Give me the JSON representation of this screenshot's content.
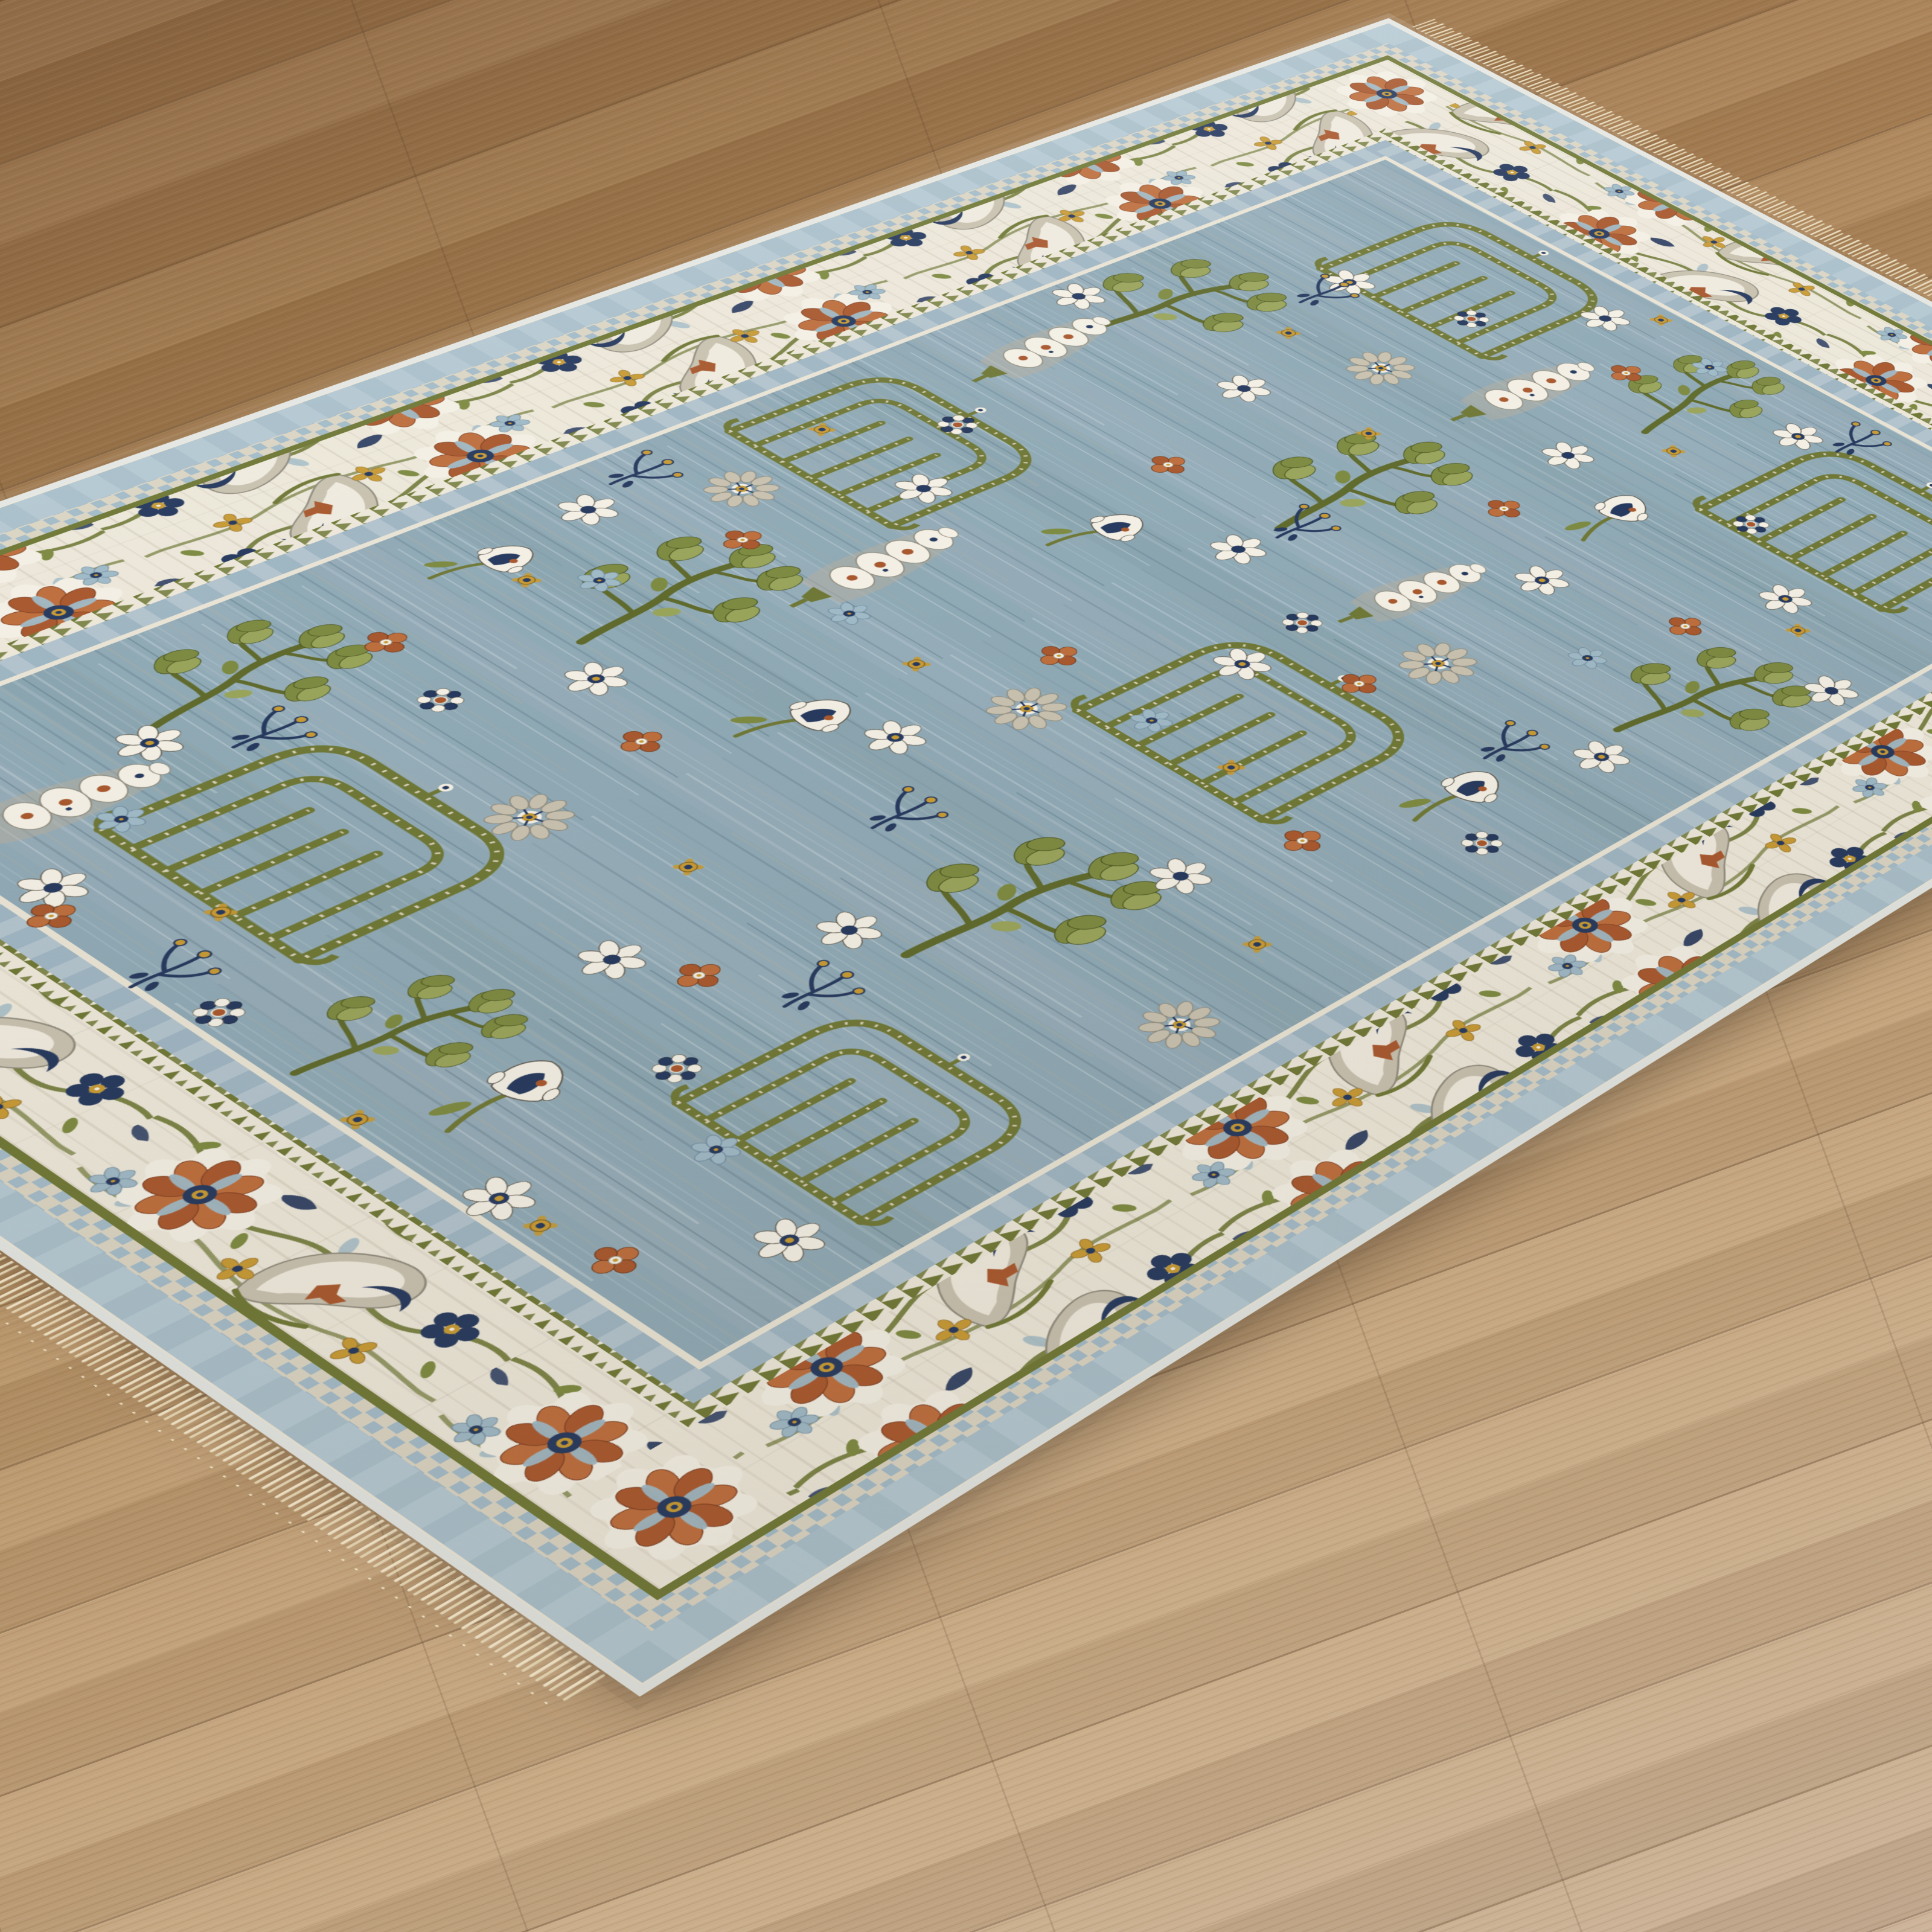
{
  "scene": {
    "description": "Angled corner view of a traditional Oushak-style area rug with a slate blue field and ivory floral border, lying on light oak wood plank flooring; cream fringe on the near and far ends",
    "floor": {
      "material": "oak-plank-floor",
      "plank_angle_deg": -20,
      "colors": {
        "c1": "#8a6440",
        "c2": "#9a744a",
        "c3": "#a98156",
        "c4": "#b49064",
        "c5": "#bf9e76",
        "c6": "#c7aa86",
        "c7": "#c9b096",
        "seam": "rgba(70,44,24,0.30)",
        "crossseam": "rgba(72,47,26,0.16)"
      }
    },
    "rug": {
      "style": "traditional-floral-oushak",
      "palette": {
        "field": "#8fa9b5",
        "ivory": "#ece7d9",
        "white": "#f3efe4",
        "gray_beige": "#c8c1af",
        "gray_stroke": "#8f8b7d",
        "olive": "#6f7836",
        "leaf": "#7d8a41",
        "leaf_light": "#99a45b",
        "leaf_dark": "#46511f",
        "trunk": "#5f6a2c",
        "rust": "#a8582e",
        "rust_light": "#bd6e3d",
        "navy": "#26395e",
        "gold": "#c79a35",
        "lightblue": "#9fb9c6",
        "checker_blue": "#a3bbc8",
        "checker_beige": "#dad4c3",
        "bluegray": "#9eb5c2",
        "blueband": "#a9bfca",
        "silver": "#e3e6e2",
        "hairline": "#e8e3d4",
        "fringe": "#e9dcc0",
        "fringe_dark": "#ddcdab",
        "dot": "#d8d1bd"
      },
      "border": {
        "motif_cycle": [
          "rust-rosette",
          "gray-palmette",
          "navy-trefoil",
          "gold-floret",
          "olive-vine"
        ],
        "rings": [
          {
            "name": "silver-binding",
            "inset": 5,
            "width": 10,
            "color": "silver"
          },
          {
            "name": "blue-outer-band",
            "inset": 35,
            "width": 46,
            "color": "blueband",
            "dash": {
              "color": "#bdd0d9",
              "array": "34 30",
              "opacity": 0.55
            }
          },
          {
            "name": "checker-guard",
            "inset": 72,
            "width": 28,
            "pattern": "pat-check"
          },
          {
            "name": "olive-line",
            "inset": 91,
            "width": 10,
            "color": "olive"
          },
          {
            "name": "sawtooth-guard",
            "inset": 262,
            "width": 24,
            "pattern": "pat-saw"
          },
          {
            "name": "bluegray-band",
            "inset": 291,
            "width": 34,
            "color": "bluegray",
            "dash": {
              "color": "#c6d2d8",
              "array": "22 26",
              "opacity": 0.5
            }
          },
          {
            "name": "ivory-hairline",
            "inset": 312,
            "width": 8,
            "color": "hairline"
          }
        ],
        "ivory_ring": {
          "outer": 96,
          "inner": 250
        },
        "field_inset": 316
      },
      "field_motifs": [
        {
          "t": "trellis",
          "x": 0.32,
          "y": 0.17
        },
        {
          "t": "trellis",
          "x": 0.7,
          "y": 0.19,
          "s": 1.05
        },
        {
          "t": "trellis",
          "x": 0.25,
          "y": 0.465,
          "s": 0.95
        },
        {
          "t": "trellis",
          "x": 0.615,
          "y": 0.5
        },
        {
          "t": "trellis",
          "x": 0.38,
          "y": 0.8,
          "s": 1.05
        },
        {
          "t": "trellis",
          "x": 0.745,
          "y": 0.77,
          "s": 0.9
        },
        {
          "t": "branch",
          "x": 0.52,
          "y": 0.16,
          "s": 0.9,
          "r": -8
        },
        {
          "t": "branch",
          "x": 0.22,
          "y": 0.285,
          "r": 6
        },
        {
          "t": "branch",
          "x": 0.46,
          "y": 0.335,
          "s": 1.05,
          "r": -4
        },
        {
          "t": "branch",
          "x": 0.77,
          "y": 0.345,
          "s": 0.95,
          "r": 10
        },
        {
          "t": "branch",
          "x": 0.3,
          "y": 0.6,
          "r": -6
        },
        {
          "t": "branch",
          "x": 0.66,
          "y": 0.645,
          "s": 1.05,
          "r": 5
        },
        {
          "t": "branch",
          "x": 0.225,
          "y": 0.75,
          "s": 0.9,
          "r": -10
        },
        {
          "t": "branch",
          "x": 0.54,
          "y": 0.845,
          "s": 0.8,
          "r": 8
        },
        {
          "t": "pod",
          "x": 0.445,
          "y": 0.215,
          "r": 3
        },
        {
          "t": "pod",
          "x": 0.215,
          "y": 0.355,
          "s": 0.95,
          "r": -5
        },
        {
          "t": "pod",
          "x": 0.575,
          "y": 0.375,
          "s": 0.9,
          "r": 6
        },
        {
          "t": "pod",
          "x": 0.35,
          "y": 0.525,
          "r": -3
        },
        {
          "t": "pod",
          "x": 0.27,
          "y": 0.84,
          "s": 0.95,
          "r": 4
        },
        {
          "t": "tulip",
          "x": 0.59,
          "y": 0.27,
          "r": -15
        },
        {
          "t": "tulip",
          "x": 0.4,
          "y": 0.445,
          "s": 0.95,
          "r": 10
        },
        {
          "t": "tulip",
          "x": 0.745,
          "y": 0.475,
          "r": -5
        },
        {
          "t": "tulip",
          "x": 0.445,
          "y": 0.625,
          "r": 12
        },
        {
          "t": "tulip",
          "x": 0.615,
          "y": 0.845,
          "s": 1.05,
          "r": -10
        },
        {
          "t": "tulip",
          "x": 0.21,
          "y": 0.64,
          "s": 0.9,
          "r": 8
        },
        {
          "t": "rosette",
          "x": 0.365,
          "y": 0.255
        },
        {
          "t": "rosette",
          "x": 0.64,
          "y": 0.41,
          "s": 1.05
        },
        {
          "t": "rosette",
          "x": 0.235,
          "y": 0.53,
          "s": 0.95
        },
        {
          "t": "rosette",
          "x": 0.52,
          "y": 0.555
        },
        {
          "t": "rosette",
          "x": 0.43,
          "y": 0.735
        },
        {
          "t": "rosette",
          "x": 0.8,
          "y": 0.655,
          "s": 0.95
        },
        {
          "t": "daisy",
          "x": 0.41,
          "y": 0.14
        },
        {
          "t": "daisy",
          "x": 0.8,
          "y": 0.125
        },
        {
          "t": "daisy",
          "x": 0.52,
          "y": 0.245
        },
        {
          "t": "daisy",
          "x": 0.33,
          "y": 0.315
        },
        {
          "t": "daisy",
          "x": 0.82,
          "y": 0.3
        },
        {
          "t": "daisy",
          "x": 0.47,
          "y": 0.41
        },
        {
          "t": "daisy",
          "x": 0.3,
          "y": 0.475
        },
        {
          "t": "daisy",
          "x": 0.2,
          "y": 0.585
        },
        {
          "t": "daisy",
          "x": 0.7,
          "y": 0.59
        },
        {
          "t": "daisy",
          "x": 0.62,
          "y": 0.7
        },
        {
          "t": "daisy",
          "x": 0.56,
          "y": 0.77
        },
        {
          "t": "daisy",
          "x": 0.33,
          "y": 0.875
        },
        {
          "t": "daisy",
          "x": 0.178,
          "y": 0.315
        },
        {
          "t": "daisyg",
          "x": 0.6,
          "y": 0.15
        },
        {
          "t": "daisyg",
          "x": 0.27,
          "y": 0.21
        },
        {
          "t": "daisyg",
          "x": 0.73,
          "y": 0.26
        },
        {
          "t": "daisyg",
          "x": 0.615,
          "y": 0.33
        },
        {
          "t": "daisyg",
          "x": 0.775,
          "y": 0.41
        },
        {
          "t": "daisyg",
          "x": 0.565,
          "y": 0.47
        },
        {
          "t": "daisyg",
          "x": 0.495,
          "y": 0.605
        },
        {
          "t": "daisyg",
          "x": 0.345,
          "y": 0.66
        },
        {
          "t": "daisyg",
          "x": 0.25,
          "y": 0.8
        },
        {
          "t": "daisyg",
          "x": 0.8,
          "y": 0.83
        },
        {
          "t": "daisyg",
          "x": 0.68,
          "y": 0.88
        },
        {
          "t": "clover",
          "x": 0.47,
          "y": 0.17
        },
        {
          "t": "clover",
          "x": 0.54,
          "y": 0.3
        },
        {
          "t": "clover",
          "x": 0.71,
          "y": 0.31
        },
        {
          "t": "clover",
          "x": 0.37,
          "y": 0.385
        },
        {
          "t": "clover",
          "x": 0.625,
          "y": 0.445
        },
        {
          "t": "clover",
          "x": 0.28,
          "y": 0.555
        },
        {
          "t": "clover",
          "x": 0.49,
          "y": 0.52
        },
        {
          "t": "clover",
          "x": 0.72,
          "y": 0.54
        },
        {
          "t": "clover",
          "x": 0.41,
          "y": 0.675
        },
        {
          "t": "clover",
          "x": 0.245,
          "y": 0.7
        },
        {
          "t": "clover",
          "x": 0.6,
          "y": 0.755
        },
        {
          "t": "clover",
          "x": 0.35,
          "y": 0.885
        },
        {
          "t": "clover",
          "x": 0.755,
          "y": 0.875
        },
        {
          "t": "checker",
          "x": 0.355,
          "y": 0.19
        },
        {
          "t": "checker",
          "x": 0.655,
          "y": 0.225
        },
        {
          "t": "checker",
          "x": 0.255,
          "y": 0.43
        },
        {
          "t": "checker",
          "x": 0.555,
          "y": 0.43
        },
        {
          "t": "checker",
          "x": 0.79,
          "y": 0.49
        },
        {
          "t": "checker",
          "x": 0.31,
          "y": 0.71
        },
        {
          "t": "checker",
          "x": 0.655,
          "y": 0.795
        },
        {
          "t": "checker",
          "x": 0.47,
          "y": 0.88
        },
        {
          "t": "checker",
          "x": 0.215,
          "y": 0.87
        },
        {
          "t": "goldbud",
          "x": 0.435,
          "y": 0.12
        },
        {
          "t": "goldbud",
          "x": 0.56,
          "y": 0.205
        },
        {
          "t": "goldbud",
          "x": 0.295,
          "y": 0.265
        },
        {
          "t": "goldbud",
          "x": 0.76,
          "y": 0.275
        },
        {
          "t": "goldbud",
          "x": 0.42,
          "y": 0.3
        },
        {
          "t": "goldbud",
          "x": 0.21,
          "y": 0.475
        },
        {
          "t": "goldbud",
          "x": 0.64,
          "y": 0.525
        },
        {
          "t": "goldbud",
          "x": 0.445,
          "y": 0.565
        },
        {
          "t": "goldbud",
          "x": 0.775,
          "y": 0.6
        },
        {
          "t": "goldbud",
          "x": 0.24,
          "y": 0.635
        },
        {
          "t": "goldbud",
          "x": 0.52,
          "y": 0.715
        },
        {
          "t": "goldbud",
          "x": 0.4,
          "y": 0.845
        },
        {
          "t": "goldbud",
          "x": 0.71,
          "y": 0.88
        },
        {
          "t": "goldbud",
          "x": 0.585,
          "y": 0.885
        },
        {
          "t": "sprig",
          "x": 0.63,
          "y": 0.13
        },
        {
          "t": "sprig",
          "x": 0.27,
          "y": 0.225
        },
        {
          "t": "sprig",
          "x": 0.475,
          "y": 0.375
        },
        {
          "t": "sprig",
          "x": 0.73,
          "y": 0.43
        },
        {
          "t": "sprig",
          "x": 0.185,
          "y": 0.55
        },
        {
          "t": "sprig",
          "x": 0.555,
          "y": 0.635
        },
        {
          "t": "sprig",
          "x": 0.28,
          "y": 0.765
        },
        {
          "t": "sprig",
          "x": 0.65,
          "y": 0.73
        },
        {
          "t": "sprig",
          "x": 0.425,
          "y": 0.875
        },
        {
          "t": "bluedaisy",
          "x": 0.5,
          "y": 0.135
        },
        {
          "t": "bluedaisy",
          "x": 0.695,
          "y": 0.36
        },
        {
          "t": "bluedaisy",
          "x": 0.38,
          "y": 0.56
        },
        {
          "t": "bluedaisy",
          "x": 0.575,
          "y": 0.525
        },
        {
          "t": "bluedaisy",
          "x": 0.265,
          "y": 0.615
        },
        {
          "t": "bluedaisy",
          "x": 0.72,
          "y": 0.815
        },
        {
          "t": "bluedaisy",
          "x": 0.3,
          "y": 0.835
        }
      ]
    }
  }
}
